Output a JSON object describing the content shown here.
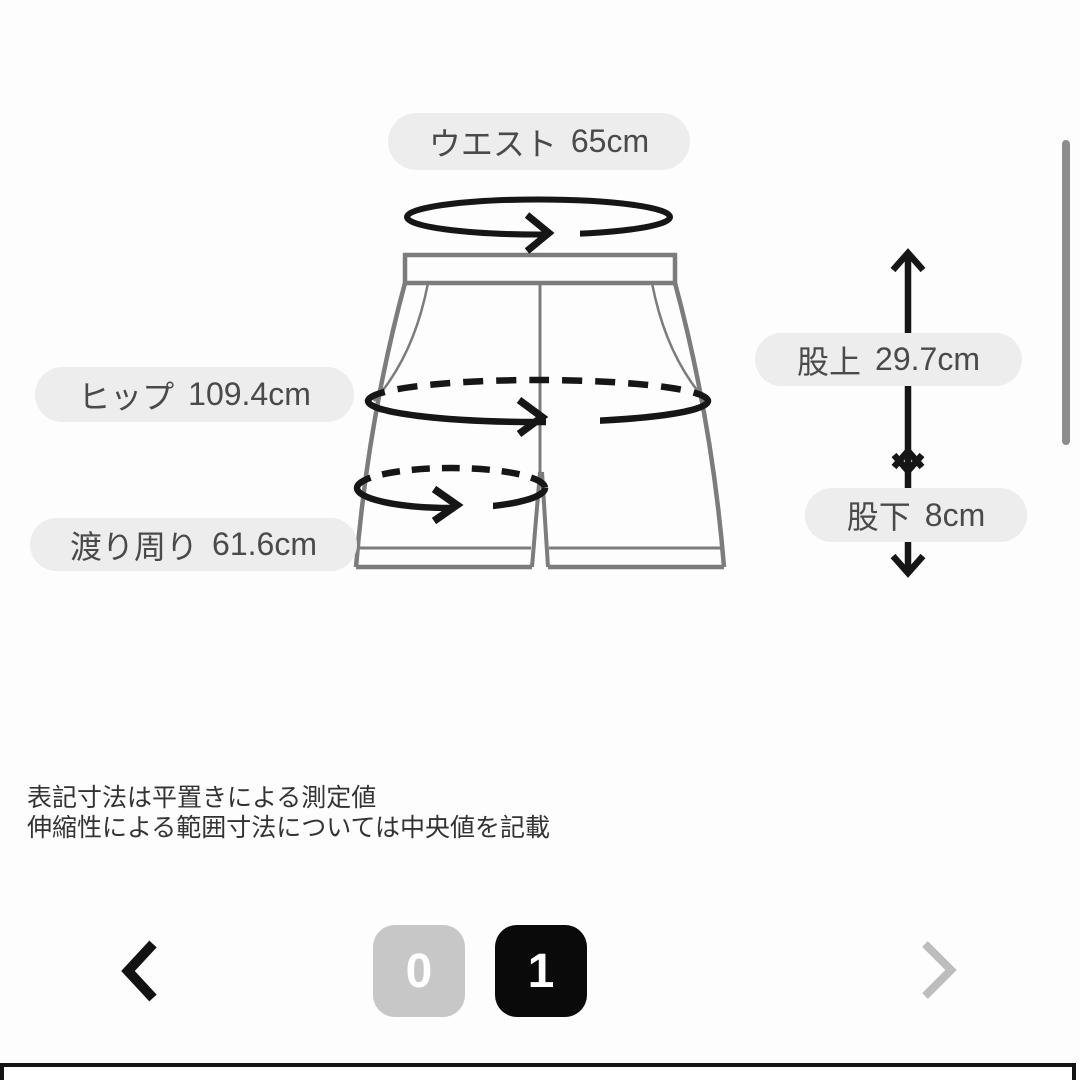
{
  "measurements": [
    {
      "id": "waist",
      "label": "ウエスト",
      "value": "65cm"
    },
    {
      "id": "hip",
      "label": "ヒップ",
      "value": "109.4cm"
    },
    {
      "id": "thigh",
      "label": "渡り周り",
      "value": "61.6cm"
    },
    {
      "id": "rise",
      "label": "股上",
      "value": "29.7cm"
    },
    {
      "id": "inseam",
      "label": "股下",
      "value": "8cm"
    }
  ],
  "notes": [
    "表記寸法は平置きによる測定値",
    "伸縮性による範囲寸法については中央値を記載"
  ],
  "pagination": {
    "prev_icon": "chevron-left",
    "next_icon": "chevron-right",
    "pages": [
      {
        "label": "0",
        "active": false
      },
      {
        "label": "1",
        "active": true
      }
    ]
  },
  "colors": {
    "background": "#fdfdfd",
    "pill_background": "#ededed",
    "pill_text": "#4a4a4a",
    "garment_outline": "#7c7c7c",
    "measurement_arrow": "#161616",
    "page_active": "#0a0a0a",
    "page_inactive": "#c7c7c7",
    "next_chevron": "#bdbdbd",
    "scrollbar": "#8d8d8d",
    "notes_text": "#333333"
  }
}
